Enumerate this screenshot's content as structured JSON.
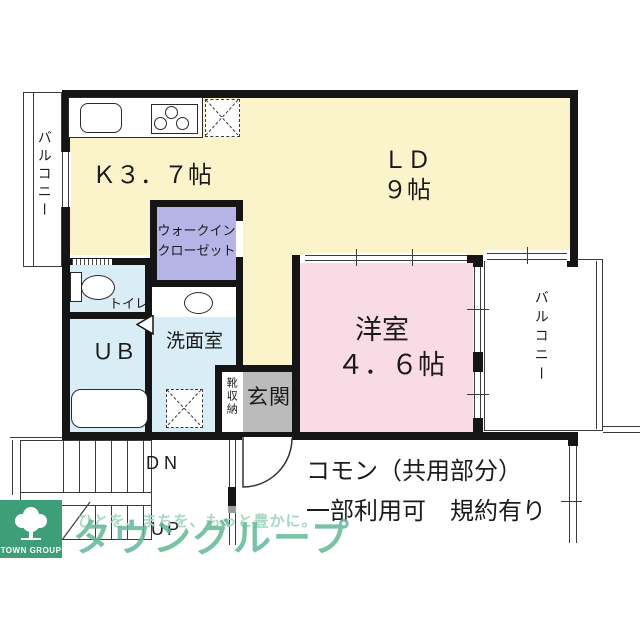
{
  "plan": {
    "rooms": {
      "kitchen": {
        "label": "Ｋ３．７帖"
      },
      "living_dining": {
        "label": "ＬＤ",
        "size": "９帖"
      },
      "bedroom": {
        "label": "洋室",
        "size": "４．６帖"
      },
      "walk_in_closet": {
        "line1": "ウォークイン",
        "line2": "クローゼット"
      },
      "toilet": {
        "label": "トイレ"
      },
      "unit_bath": {
        "label": "ＵＢ"
      },
      "washroom": {
        "label": "洗面室"
      },
      "shoe_storage": {
        "label": "靴収納"
      },
      "entrance": {
        "label": "玄関"
      },
      "balcony_left": {
        "label": "バルコニー"
      },
      "balcony_right": {
        "label": "バルコニー"
      }
    },
    "stairs": {
      "down": "DN",
      "up": "UP"
    },
    "notes": {
      "line1": "コモン（共用部分）",
      "line2": "一部利用可　規約有り"
    }
  },
  "watermark": {
    "tagline": "ひとを、まちを、もっと豊かに。",
    "brand": "タウングループ",
    "logo_caption": "TOWN GROUP"
  },
  "colors": {
    "ldk": "#FBF3CA",
    "bedroom": "#F9DBE5",
    "wet_rooms": "#D8EDF5",
    "closet": "#B6B4E6",
    "entrance": "#BBBBBB",
    "wall": "#151515",
    "logo_green": "#3C9F78",
    "brand_green": "#5FB894"
  }
}
